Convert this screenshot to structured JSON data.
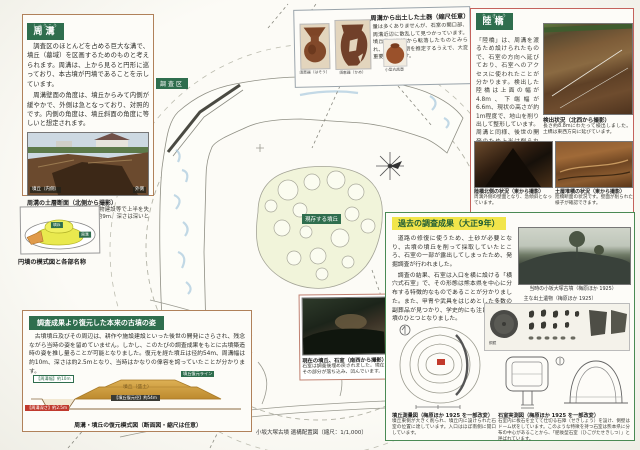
{
  "shuko": {
    "title": "周溝",
    "furigana": "しゅうこう",
    "para1": "調査区のほとんどを占める巨大な溝で、墳丘（墓域）を区画するためのものと考えられます。周溝は、上から見ると円形に巡っており、本古墳が円墳であることを示しています。",
    "para2": "周溝壁面の角度は、墳丘からみて内側が緩やかで、外側は急となっており、対照的です。内側の角度は、墳丘斜面の角度に等しいと想定されます。",
    "photo_label_left": "墳丘（内側）",
    "photo_label_right": "外側",
    "photo_caption": "周溝の土層断面（北側から撮影）",
    "photo_note": "墳丘と同様、後世の耕作や建物建設等で上半を失っていますが、それでも幅は約9m、深さは深いところで約2mにもなります。"
  },
  "model": {
    "caption": "円墳の模式図と各部名称",
    "label_mound": "墳丘",
    "label_moat": "周溝"
  },
  "pottery": {
    "title": "周溝から出土した土器（縮尺任意）",
    "body": "量は多くありませんが、石室の開口部、周溝近辺に散乱して見つかっています。墳丘及び周溝から転落したものとみられ、古墳の時期を推定するうえで、大変重要な資料です。",
    "captions": [
      "須恵器（はそう）",
      "須恵器（かめ）",
      "小型丸底壺"
    ]
  },
  "rikkyo": {
    "title": "陸橋",
    "furigana": "りっきょう",
    "body": "「陸橋」は、周溝を渡るため設けられたもので、石室の方向へ延びており、石室へのアクセスに使われたことが分かります。検出した陸橋は上面の幅が4.8m、下端幅が6.6m、現状の高さが約1m程度で、地山を削り出して整形しています。周溝と同様、後世の開発のため上半は削られています。",
    "photo1_caption": "検出状況（北西から撮影）",
    "photo1_note": "長さ約8.8mにわたって検出しました。土橋は東西方向に延びています。",
    "photo2_caption": "陸橋北側の状況（東から撮影）",
    "photo2_note": "周溝外側の壁面となり、急傾斜となっています。",
    "photo3_caption": "土層堆積の状況（東から撮影）",
    "photo3_note": "陸橋断面の状況です。壁面が削られた様子が確認できます。"
  },
  "taisho": {
    "title": "過去の調査成果（大正9年）",
    "para1": "道路の修復に使うため、土砂が必要となり、古墳の墳丘を削って採取していたところ、石室の一部が露出してしまったため、発掘調査が行われました。",
    "para2": "調査の結果、石室は入口を横に設ける「横穴式石室」で、その形態は熊本県を中心に分布する特徴的なものであることが分かりました。また、甲冑や武具をはじめとした多数の副葬品が見つかり、学史的にも注目される古墳のひとつとなりました。",
    "photo_caption": "当時の小坂大塚古墳（梅原ほか 1925）",
    "artifacts_caption": "主な出土遺物（梅原ほか 1925）",
    "mirror_label": "銅鏡",
    "survey_caption": "墳丘測量図（梅原ほか 1925 を一部改変）",
    "survey_note": "墳丘東側が大きく削られ、墳丘内に設けられた石室の位置に達しています。入口はほぼ南側に開口しています。",
    "sekishitsu_caption": "石室実測図（梅原ほか 1925 を一部改変）",
    "sekishitsu_note": "石室内に板石を立てて仕切る石障（せきしょう）を設け、側壁はドーム状をしています。このような特徴を持つ石室は熊本県に分布の中心があることから、「肥後型石室（ひごがたせきしつ）」と呼ばれています。"
  },
  "restore": {
    "title": "調査成果より復元した本来の古墳の姿",
    "para": "古墳墳丘及びその周辺は、耕作や施設建設といった後世の開発にさらされ、残念ながら当時の姿を留めていません。しかし、このたびの調査成果をもとに古墳築造時の姿を推し量ることが可能となりました。復元を経た墳丘は径約54m、周溝幅は約10m、深さは約2.5mとなり、当時はかなりの偉容を誇っていたことが分かります。",
    "label_moat_width": "【周溝幅】約10m",
    "label_moat_depth": "【周溝深さ】約2.5m",
    "label_diameter": "【墳丘復元径】約54m",
    "label_line": "墳丘復元ライン",
    "label_mound": "墳丘（盛土）",
    "caption": "周溝・墳丘の復元模式図（断面図・縮尺は任意）"
  },
  "map": {
    "survey_area": "調査区",
    "mound_label": "現存する墳丘",
    "photo_caption": "現在の墳丘、石室（南西から撮影）",
    "photo_note": "石室は調査後埋め戻されました。現在はその部分が落ち込み、凹んでいます。",
    "caption": "小坂大塚古墳 遺構配置図（縮尺：1/1,000）"
  }
}
